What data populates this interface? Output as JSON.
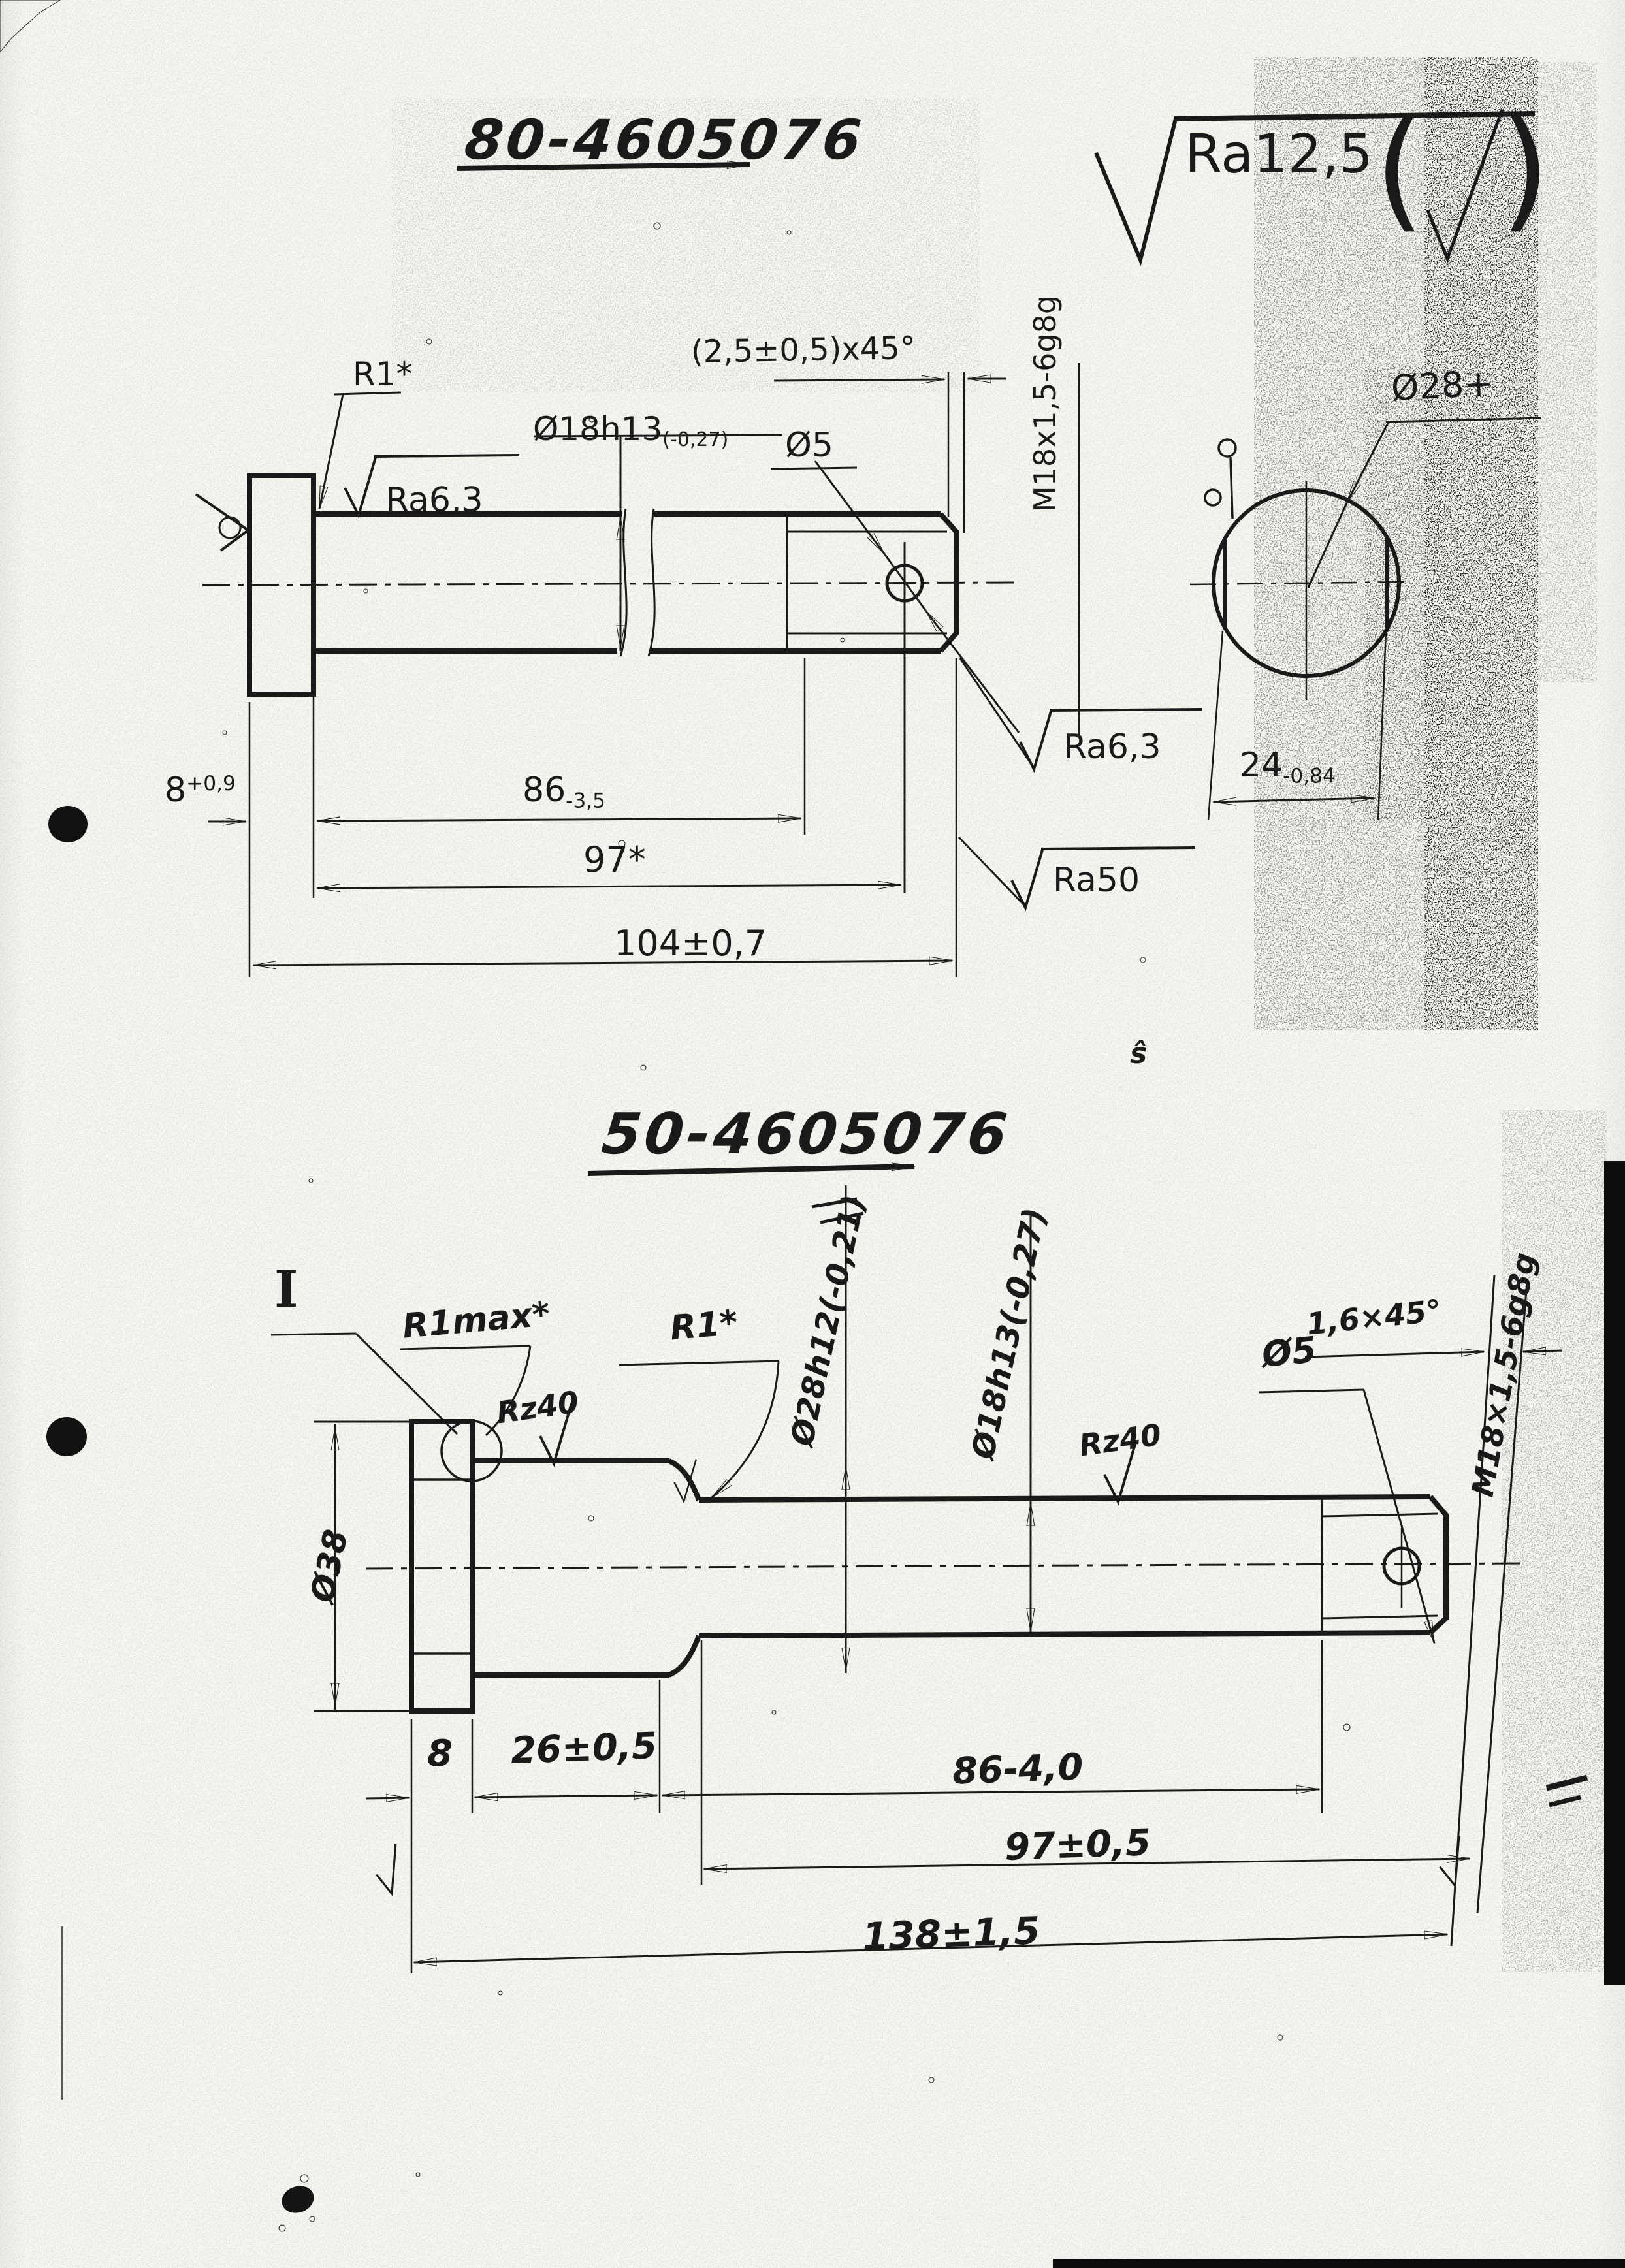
{
  "page": {
    "background": "#f6f5f0",
    "ink": "#1a1a1a"
  },
  "top_drawing": {
    "title": "80-4605076",
    "general_roughness": "Ra12,5",
    "roughness_parens": [
      "(",
      ")"
    ],
    "labels": {
      "fillet": "R1*",
      "surface_shaft": "Ra6,3",
      "shaft_dia_main": "Ø18h13",
      "shaft_dia_tol": "(-0,27)",
      "hole_dia": "Ø5",
      "chamfer": "(2,5±0,5)x45°",
      "thread": "M18x1,5-6g8g",
      "surface_thread": "Ra6,3",
      "surface_relief": "Ra50",
      "head_dia": "Ø28+",
      "across_flats_main": "24",
      "across_flats_tol": "-0,84"
    },
    "dims": {
      "head_len_main": "8",
      "head_len_tol": "+0,9",
      "shaft_len_main": "86",
      "shaft_len_tol": "-3,5",
      "hole_pos": "97*",
      "total_len": "104±0,7"
    }
  },
  "bottom_drawing": {
    "title": "50-4605076",
    "section_mark": "I",
    "labels": {
      "fillet_max": "R1max*",
      "surface_head": "Rz40",
      "fillet": "R1*",
      "shoulder_dia": "Ø28h12(-0,21)",
      "shaft_dia": "Ø18h13(-0,27)",
      "surface_shaft": "Rz40",
      "hole_dia": "Ø5",
      "chamfer": "1,6×45°",
      "thread": "M18×1,5-6g8g",
      "head_dia": "Ø38"
    },
    "dims": {
      "head_len": "8",
      "shoulder_len": "26±0,5",
      "thread_len": "86-4,0",
      "shaft_len": "97±0,5",
      "total_len": "138±1,5"
    }
  },
  "artifacts": {
    "scribble": "ŝ"
  }
}
